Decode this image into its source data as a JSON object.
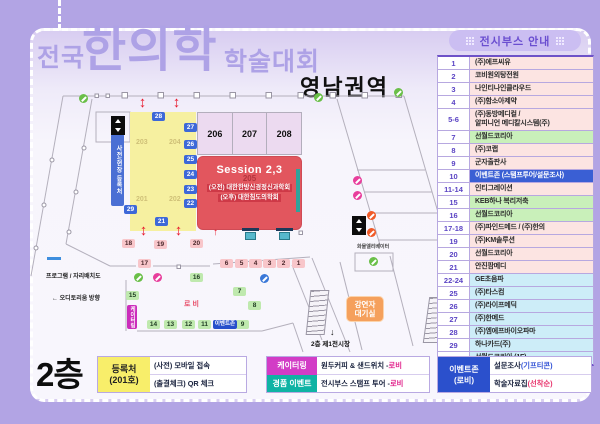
{
  "title": {
    "prefix": "전국",
    "main": "한의학",
    "suffix": "학술대회",
    "region": "영남권역"
  },
  "booth_panel": {
    "header": "전시부스 안내",
    "rows": [
      {
        "no": "1",
        "name": "(주)에프씨유",
        "type": "pink"
      },
      {
        "no": "2",
        "name": "코비원외탕전원",
        "type": "pink"
      },
      {
        "no": "3",
        "name": "나인티나인클라우드",
        "type": "pink"
      },
      {
        "no": "4",
        "name": "(주)함소아제약",
        "type": "pink"
      },
      {
        "no": "5-6",
        "name": "(주)동방메디컬 /\n알피니언 메디칼시스템(주)",
        "type": "pink tall"
      },
      {
        "no": "7",
        "name": "선월드코리아",
        "type": "green"
      },
      {
        "no": "8",
        "name": "(주)코랩",
        "type": "pink"
      },
      {
        "no": "9",
        "name": "군자출판사",
        "type": "pink"
      },
      {
        "no": "10",
        "name": "이벤트존 (스탬프투어/설문조사)",
        "type": "hl"
      },
      {
        "no": "11-14",
        "name": "인티그레이션",
        "type": "pink"
      },
      {
        "no": "15",
        "name": "KEB하나 복리저축",
        "type": "green"
      },
      {
        "no": "16",
        "name": "선월드코리아",
        "type": "green"
      },
      {
        "no": "17-18",
        "name": "(주)파인드메드 / (주)한의",
        "type": "pink"
      },
      {
        "no": "19",
        "name": "(주)KM솔루션",
        "type": "pink"
      },
      {
        "no": "20",
        "name": "선월드코리아",
        "type": "pink"
      },
      {
        "no": "21",
        "name": "안진팜메디",
        "type": "pink"
      },
      {
        "no": "22-24",
        "name": "GE초음파",
        "type": "blue"
      },
      {
        "no": "25",
        "name": "(주)타스컴",
        "type": "blue"
      },
      {
        "no": "26",
        "name": "(주)라이프메딕",
        "type": "blue"
      },
      {
        "no": "27",
        "name": "(주)한메드",
        "type": "blue"
      },
      {
        "no": "28",
        "name": "(주)엠에프바이오파마",
        "type": "blue"
      },
      {
        "no": "29",
        "name": "하나카드(주)",
        "type": "blue"
      },
      {
        "no": "30",
        "name": "선월드코리아 (1F)",
        "type": "blue"
      }
    ]
  },
  "map": {
    "registration_label": "사전/현장 등록처",
    "room_labels": [
      "206",
      "207",
      "208"
    ],
    "hall_numbers": [
      "203",
      "204",
      "201",
      "202"
    ],
    "session": {
      "title": "Session 2,3",
      "room": "205",
      "line1": "(오전) 대한한방신경정신과학회",
      "line2": "(오후) 대한침도의학회"
    },
    "labels": {
      "lobby": "로비",
      "program": "프로그램 / 자리배치도",
      "auditorium": "← 오디토리움 방향",
      "speaker1": "강연자",
      "speaker2": "대기실",
      "cargo_elevator": "화물엘리베이터",
      "floor_exit": "2층 제1전시장",
      "exit_arrow": "↓"
    },
    "badges": [
      {
        "n": "28",
        "x": 152,
        "y": 112,
        "type": "blue"
      },
      {
        "n": "27",
        "x": 184,
        "y": 123,
        "type": "blue"
      },
      {
        "n": "26",
        "x": 184,
        "y": 140,
        "type": "blue"
      },
      {
        "n": "25",
        "x": 184,
        "y": 155,
        "type": "blue"
      },
      {
        "n": "24",
        "x": 184,
        "y": 170,
        "type": "blue"
      },
      {
        "n": "23",
        "x": 184,
        "y": 185,
        "type": "blue"
      },
      {
        "n": "22",
        "x": 184,
        "y": 199,
        "type": "blue"
      },
      {
        "n": "21",
        "x": 155,
        "y": 217,
        "type": "blue"
      },
      {
        "n": "29",
        "x": 124,
        "y": 205,
        "type": "blue"
      },
      {
        "n": "18",
        "x": 122,
        "y": 239,
        "type": "pink"
      },
      {
        "n": "19",
        "x": 154,
        "y": 240,
        "type": "pink"
      },
      {
        "n": "20",
        "x": 190,
        "y": 239,
        "type": "pink"
      },
      {
        "n": "17",
        "x": 138,
        "y": 259,
        "type": "pink"
      },
      {
        "n": "6",
        "x": 220,
        "y": 259,
        "type": "pink"
      },
      {
        "n": "5",
        "x": 235,
        "y": 259,
        "type": "pink"
      },
      {
        "n": "4",
        "x": 249,
        "y": 259,
        "type": "pink"
      },
      {
        "n": "3",
        "x": 263,
        "y": 259,
        "type": "pink"
      },
      {
        "n": "2",
        "x": 277,
        "y": 259,
        "type": "pink"
      },
      {
        "n": "1",
        "x": 292,
        "y": 259,
        "type": "pink"
      },
      {
        "n": "16",
        "x": 190,
        "y": 273,
        "type": "green"
      },
      {
        "n": "15",
        "x": 126,
        "y": 291,
        "type": "green"
      },
      {
        "n": "7",
        "x": 233,
        "y": 287,
        "type": "green"
      },
      {
        "n": "8",
        "x": 248,
        "y": 301,
        "type": "green"
      },
      {
        "n": "14",
        "x": 147,
        "y": 320,
        "type": "green"
      },
      {
        "n": "13",
        "x": 164,
        "y": 320,
        "type": "green"
      },
      {
        "n": "12",
        "x": 182,
        "y": 320,
        "type": "green"
      },
      {
        "n": "11",
        "x": 198,
        "y": 320,
        "type": "green"
      },
      {
        "n": "9",
        "x": 236,
        "y": 320,
        "type": "green"
      },
      {
        "n": "이벤트존",
        "x": 213,
        "y": 320,
        "type": "ez"
      },
      {
        "n": "케이터링",
        "x": 127,
        "y": 305,
        "type": "cat"
      },
      {
        "n": "↕",
        "x": 136,
        "y": 96,
        "type": "arrow"
      },
      {
        "n": "↕",
        "x": 170,
        "y": 96,
        "type": "arrow"
      },
      {
        "n": "↕",
        "x": 137,
        "y": 224,
        "type": "arrow"
      },
      {
        "n": "↕",
        "x": 172,
        "y": 224,
        "type": "arrow"
      },
      {
        "n": "↑",
        "x": 209,
        "y": 227,
        "type": "arrow small"
      }
    ]
  },
  "legend": {
    "floor": "2층",
    "registration": {
      "title": "등록처",
      "room": "(201호)",
      "line1": "(사전) 모바일 접속",
      "line2": "(출결체크) QR 체크"
    },
    "catering": {
      "chip1": "케이터링",
      "chip2": "경품 이벤트",
      "line1": "원두커피 & 샌드위치 - ",
      "line2": "전시부스 스탬프 투어 - ",
      "lobby1": "로비",
      "lobby2": "로비"
    },
    "event": {
      "chip1": "이벤트존",
      "chip2": "(로비)",
      "line1": "설문조사 ",
      "line1_hl": "(기프티콘)",
      "line2": "학술자료집 ",
      "line2_hl": "(선착순)"
    }
  },
  "colors": {
    "background": "#b2a4e4",
    "title_purple": "#aea2e6",
    "booth_pink": "#fce4e2",
    "booth_green": "#c9f0ba",
    "booth_blue": "#cdedf8",
    "highlight_row": "#3a5fd4",
    "session_red": "#e2565e",
    "hall_yellow": "#f6f0a0"
  }
}
